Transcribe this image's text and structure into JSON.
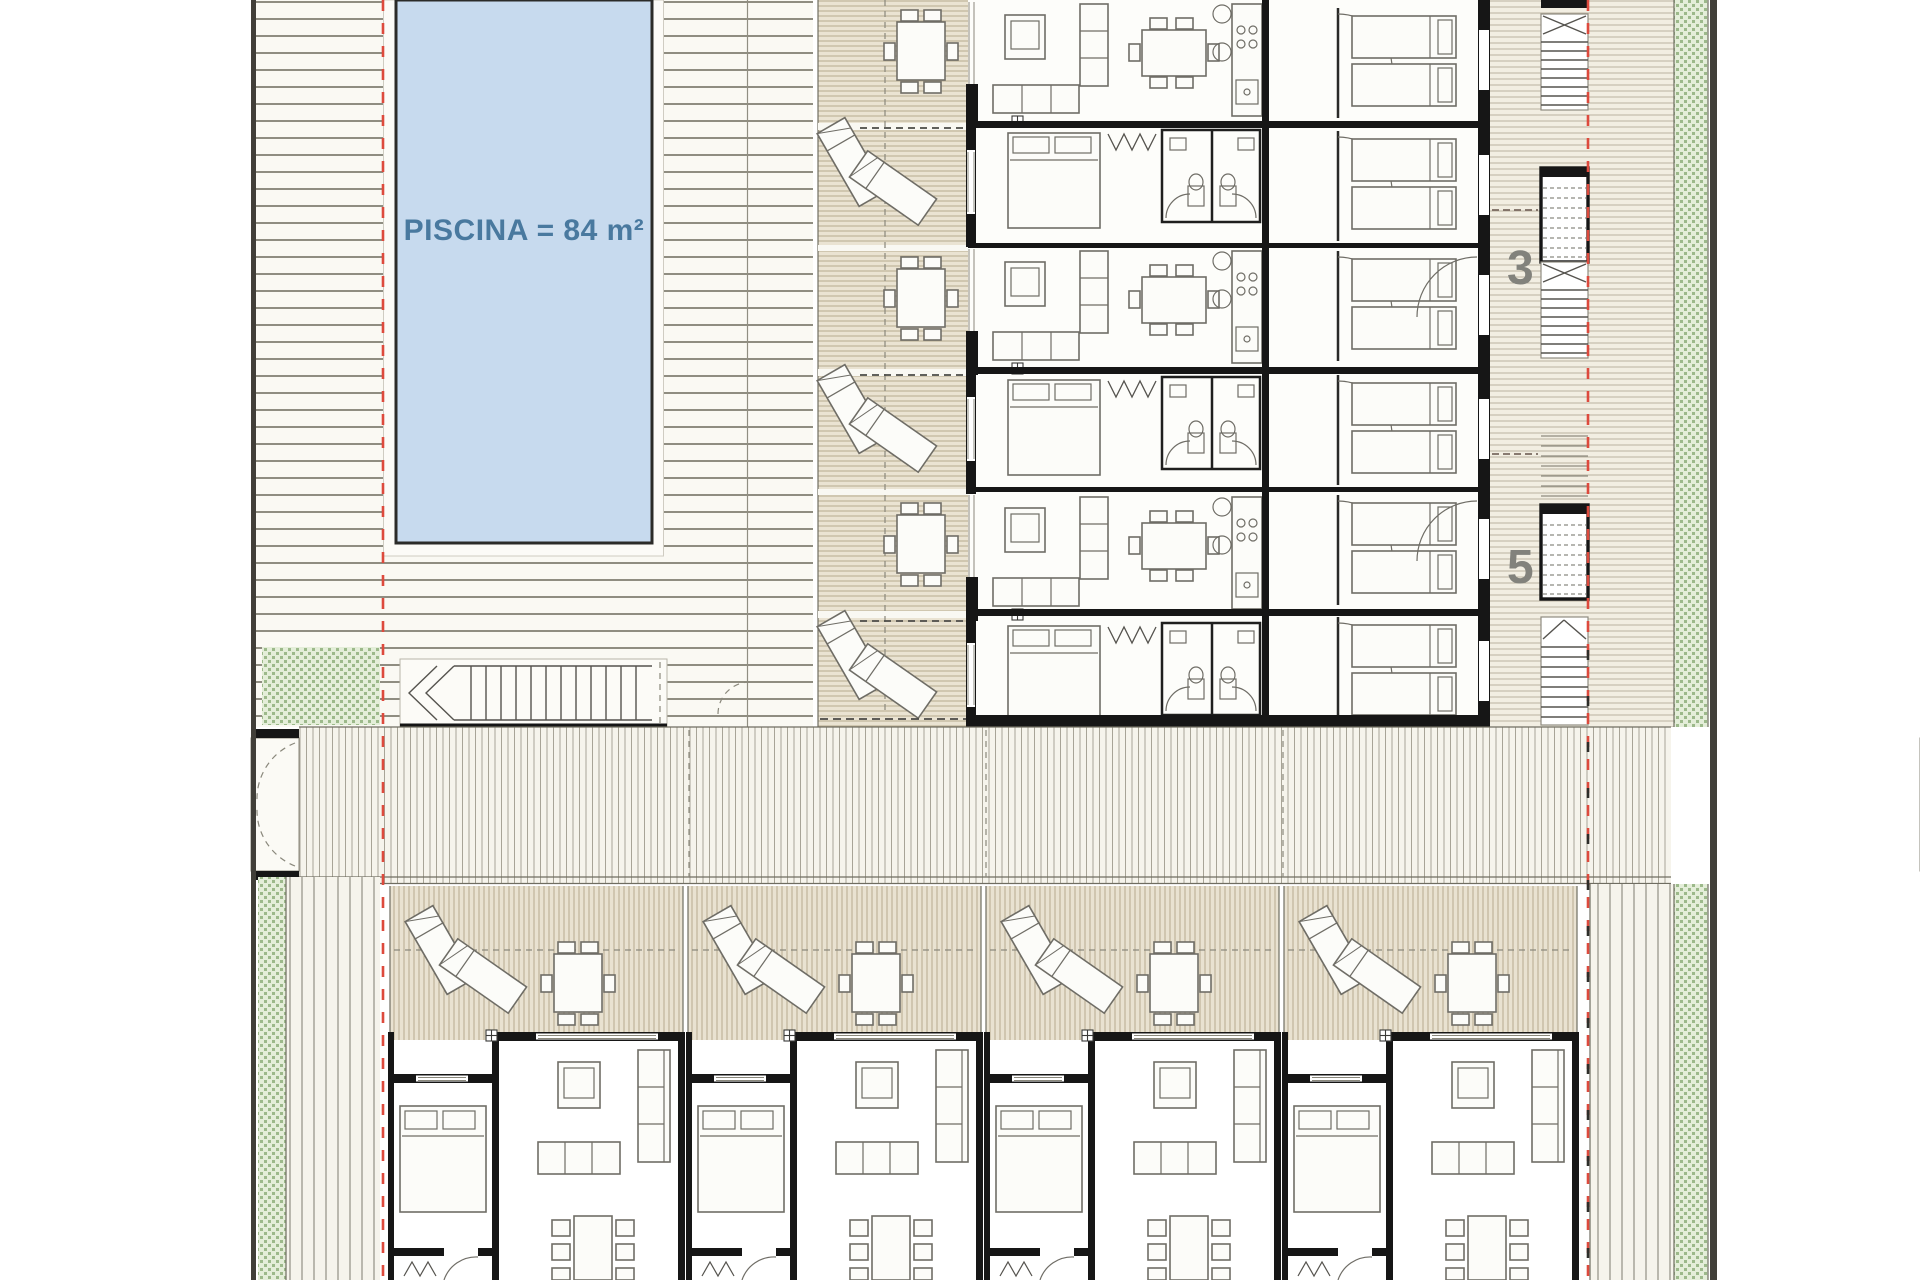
{
  "plan": {
    "title": "Residential site floor plan",
    "pool": {
      "label": "PISCINA = 84 m²",
      "area_value": "84"
    },
    "entry_numbers": [
      {
        "value": "3"
      },
      {
        "value": "5"
      }
    ],
    "colors": {
      "pool_fill": "#c7daee",
      "pool_border": "#2b2b28",
      "pool_text": "#49799f",
      "wall": "#161616",
      "red_line": "#dd4a3d",
      "number_gray": "#82827c",
      "deck_line": "#8f8d81",
      "deck_bg": "#faf9f3",
      "terrace_line": "#b7ab8e",
      "terrace_bg": "#eae3d2",
      "walkway_line": "#a8a497",
      "green_fill": "#e4eed9",
      "green_dot": "#9cb98a",
      "border": "#413f39",
      "furniture": "#6f6d66"
    }
  }
}
